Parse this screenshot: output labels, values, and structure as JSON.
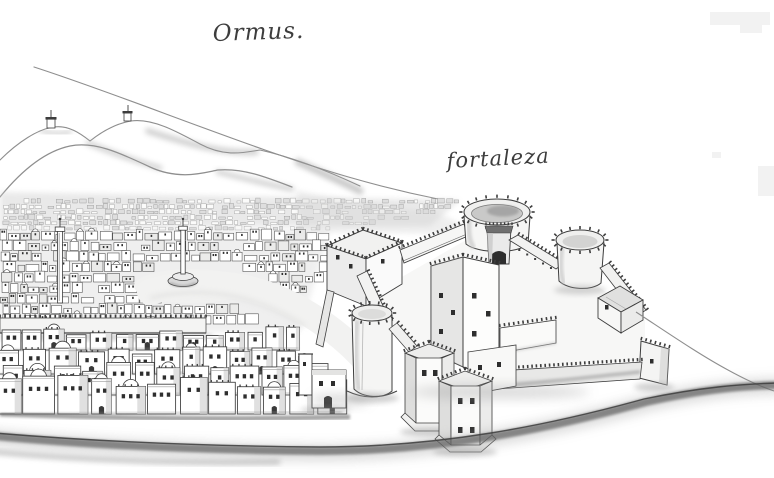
{
  "labels": {
    "city": "Ormus.",
    "fortress": "fortaleza"
  },
  "palette": {
    "paper": "#ffffff",
    "ink": "#3d3d3d",
    "ink_soft": "#8e8e8e",
    "wash": "#d6d6d6",
    "shade": "#c7c7c7",
    "shade_dark": "#9a9a9a",
    "window": "#2e2e2e",
    "shore": "#5e5e5e"
  },
  "figure": {
    "kind": "pen-and-ink panorama drawing",
    "alt": "Bird's-eye view of the town of Ormus: hills with two hilltop watchtowers behind, a dense white-walled town with two tall memorial columns at left, and the crenellated fortaleza with round bastions, a tall square keep and polygonal front towers on a coastal spit at right; a dark shoreline sweeps across the foreground."
  }
}
